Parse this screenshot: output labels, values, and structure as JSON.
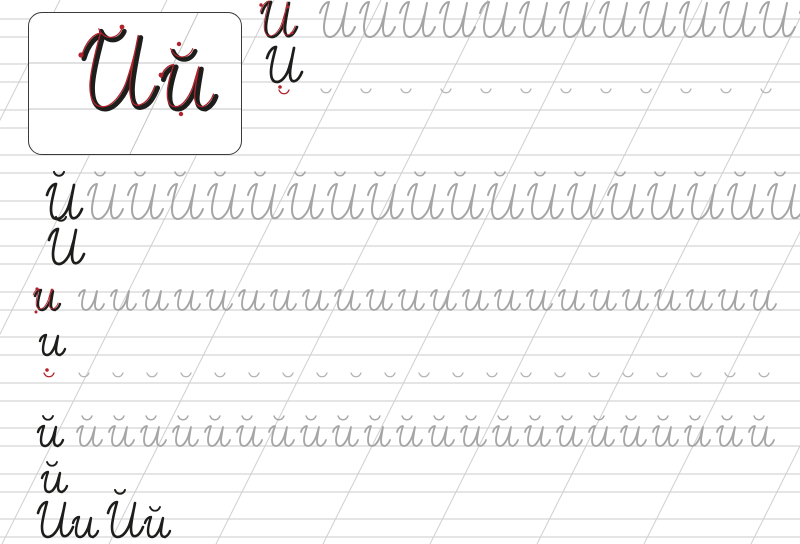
{
  "meta": {
    "description": "Cursive handwriting practice worksheet (propis) for the Cyrillic letter Й",
    "letters_practiced": [
      "И",
      "и",
      "Й",
      "й",
      "˘"
    ]
  },
  "page": {
    "width": 800,
    "height": 544
  },
  "colors": {
    "background": "#ffffff",
    "line": "#cbcbcb",
    "slant": "#cfcfcf",
    "card_line": "#c3c3c3",
    "trace": "#a5a5a5",
    "trace2": "#b4b4b4",
    "ink": "#1d1d1b",
    "red": "#b3232c"
  },
  "grid": {
    "band_height": 18,
    "baselines": [
      37,
      82,
      128,
      173,
      219,
      264,
      310,
      355,
      401,
      446,
      492,
      537
    ],
    "slant_x_tops": [
      60,
      167,
      274,
      381,
      488,
      595,
      702,
      809,
      916,
      1023
    ],
    "slant_dx": -272
  },
  "glyphs": {
    "icap": {
      "h": 38,
      "w": 46
    },
    "ilow": {
      "h": 22,
      "w": 30
    },
    "brv": {
      "h": 7,
      "w": 12
    },
    "jcap": {
      "base": "icap",
      "h": 38,
      "bdx": 16,
      "bdy": -48
    },
    "jlow": {
      "base": "ilow",
      "h": 22,
      "bdx": 9,
      "bdy": -31
    }
  },
  "rows": [
    {
      "baseline": 37,
      "items": [
        {
          "glyph": "icap",
          "x": 252,
          "color": "ink",
          "sw": 2.7,
          "red": true
        },
        {
          "glyph": "icap",
          "x0": 310,
          "step": 40,
          "count": 13,
          "color": "trace",
          "sw": 2
        }
      ]
    },
    {
      "baseline": 82,
      "items": [
        {
          "glyph": "icap",
          "x": 257,
          "color": "ink",
          "sw": 2.7
        },
        {
          "glyph": "brv",
          "x": 278,
          "y": 89,
          "color": "red",
          "sw": 1.3
        },
        {
          "glyph": "brv",
          "x0": 320,
          "step": 40,
          "count": 12,
          "y": 88,
          "color": "trace2",
          "sw": 1.3
        }
      ]
    },
    {
      "baseline": 128,
      "items": []
    },
    {
      "baseline": 173,
      "items": []
    },
    {
      "baseline": 219,
      "items": [
        {
          "glyph": "jcap",
          "x": 37,
          "color": "ink",
          "sw": 2.7
        },
        {
          "glyph": "jcap",
          "x0": 78,
          "step": 40,
          "count": 18,
          "color": "trace",
          "sw": 2
        }
      ]
    },
    {
      "baseline": 264,
      "items": [
        {
          "glyph": "jcap",
          "x": 39,
          "color": "ink",
          "sw": 2.7
        }
      ]
    },
    {
      "baseline": 310,
      "items": [
        {
          "glyph": "ilow",
          "x": 30,
          "color": "ink",
          "sw": 2.4,
          "red": true
        },
        {
          "glyph": "ilow",
          "x0": 74,
          "step": 32,
          "count": 22,
          "color": "trace",
          "sw": 1.8
        }
      ]
    },
    {
      "baseline": 355,
      "items": [
        {
          "glyph": "ilow",
          "x": 35,
          "color": "ink",
          "sw": 2.4
        },
        {
          "glyph": "brv",
          "x": 43,
          "y": 372,
          "color": "red",
          "sw": 1.3
        },
        {
          "glyph": "brv",
          "x0": 78,
          "step": 34,
          "count": 21,
          "y": 372,
          "color": "trace2",
          "sw": 1.3
        }
      ]
    },
    {
      "baseline": 401,
      "items": []
    },
    {
      "baseline": 446,
      "items": [
        {
          "glyph": "jlow",
          "x": 33,
          "color": "ink",
          "sw": 2.4
        },
        {
          "glyph": "jlow",
          "x0": 72,
          "step": 32,
          "count": 22,
          "color": "trace",
          "sw": 1.8
        }
      ]
    },
    {
      "baseline": 492,
      "items": [
        {
          "glyph": "jlow",
          "x": 37,
          "color": "ink",
          "sw": 2.4
        }
      ]
    },
    {
      "baseline": 537,
      "items": [
        {
          "glyph": "icap",
          "x": 28,
          "color": "ink",
          "sw": 2.6
        },
        {
          "glyph": "ilow",
          "x": 68,
          "color": "ink",
          "sw": 2.4
        },
        {
          "glyph": "jcap",
          "x": 98,
          "color": "ink",
          "sw": 2.6
        },
        {
          "glyph": "jlow",
          "x": 140,
          "color": "ink",
          "sw": 2.4
        }
      ]
    }
  ],
  "red_marks": [
    {
      "type": "dot",
      "x": 261,
      "y": 5,
      "r": 1.7
    },
    {
      "type": "dot",
      "x": 288,
      "y": 7,
      "r": 1.5
    },
    {
      "type": "dot",
      "x": 292,
      "y": 33,
      "r": 1.4
    },
    {
      "type": "dot",
      "x": 280,
      "y": 87,
      "r": 1.8
    },
    {
      "type": "dot",
      "x": 37,
      "y": 289,
      "r": 1.6
    },
    {
      "type": "dot",
      "x": 52,
      "y": 290,
      "r": 1.4
    },
    {
      "type": "dot",
      "x": 36,
      "y": 312,
      "r": 1.5
    },
    {
      "type": "dot",
      "x": 47,
      "y": 370,
      "r": 1.8
    }
  ],
  "card": {
    "label": "Й й",
    "capital": "Й",
    "lowercase": "й",
    "x": 28,
    "y": 12,
    "w": 214,
    "h": 143,
    "radius": 14,
    "lines": [
      50,
      96
    ],
    "slant": {
      "x1": 169,
      "y1": 0,
      "x2": 100,
      "y2": 143
    },
    "items": [
      {
        "glyph": "icap",
        "tx": 34,
        "ty": 16.2,
        "s": 2.1,
        "color": "ink",
        "sw": 2.4
      },
      {
        "glyph": "brv",
        "tx": 70,
        "ty": 16,
        "s": 2.3,
        "color": "ink",
        "sw": 2.1
      },
      {
        "glyph": "ilow",
        "tx": 124,
        "ty": 49.8,
        "s": 2.1,
        "color": "ink",
        "sw": 2.4
      },
      {
        "glyph": "brv",
        "tx": 142,
        "ty": 36,
        "s": 2.2,
        "color": "ink",
        "sw": 2.1
      },
      {
        "glyph": "icap",
        "tx": 31.5,
        "ty": 14,
        "s": 2.1,
        "color": "red",
        "sw": 0.62
      },
      {
        "glyph": "brv",
        "tx": 67.5,
        "ty": 13.5,
        "s": 2.3,
        "color": "red",
        "sw": 0.55
      },
      {
        "glyph": "ilow",
        "tx": 121.5,
        "ty": 47.5,
        "s": 2.1,
        "color": "red",
        "sw": 0.62
      },
      {
        "glyph": "brv",
        "tx": 139.5,
        "ty": 33.5,
        "s": 2.2,
        "color": "red",
        "sw": 0.55
      }
    ],
    "marks": [
      {
        "type": "dot",
        "x": 52,
        "y": 42,
        "r": 2.6
      },
      {
        "type": "dot",
        "x": 93,
        "y": 14,
        "r": 2.4
      },
      {
        "type": "dot",
        "x": 132,
        "y": 62,
        "r": 2.4
      },
      {
        "type": "dot",
        "x": 150,
        "y": 31,
        "r": 2.2
      },
      {
        "type": "dot",
        "x": 152,
        "y": 101,
        "r": 2.2
      },
      {
        "type": "arrow",
        "x": 85,
        "y": 62,
        "rot": 18
      },
      {
        "type": "arrow",
        "x": 116,
        "y": 44,
        "rot": 18
      },
      {
        "type": "arrow",
        "x": 160,
        "y": 72,
        "rot": 18
      }
    ]
  }
}
